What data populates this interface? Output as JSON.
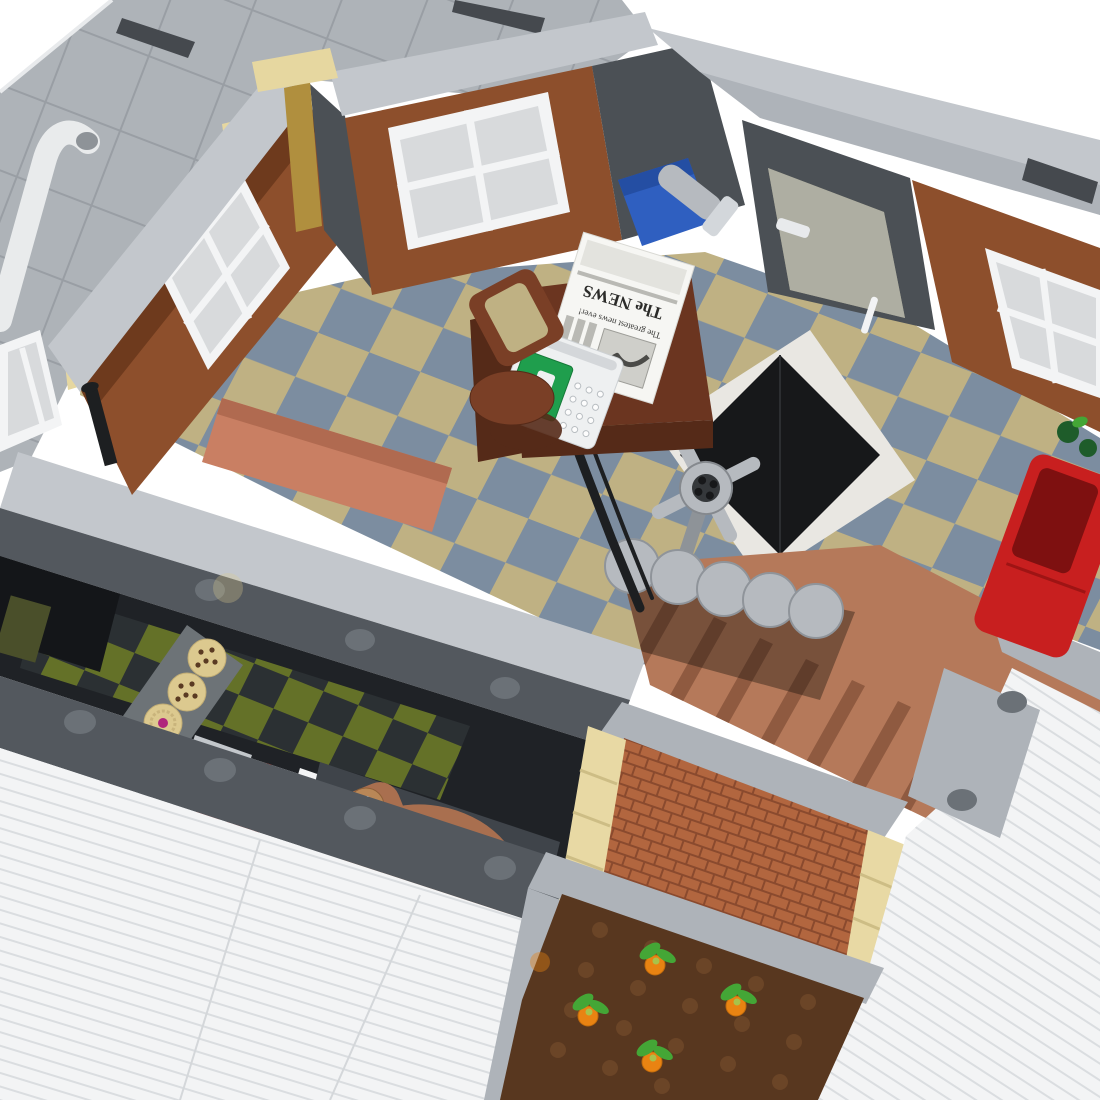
{
  "scene": {
    "subject": "LEGO modular building interior, isometric cutaway render",
    "view": "top-down three-quarter view, white studio background",
    "background": "#ffffff"
  },
  "palette": {
    "bg": "#ffffff",
    "roofGray": "#aeb3b8",
    "roofLine": "#999ea4",
    "capGray": "#c3c7cc",
    "capGray2": "#aeb3b9",
    "darkSill": "#53585e",
    "darkSill2": "#45494e",
    "studGray": "#6b7177",
    "white": "#f3f4f5",
    "windowInset": "#d8dadc",
    "woodMid": "#8d4f2c",
    "woodDark": "#6e3a1d",
    "darkWall": "#4b5055",
    "gold": "#b08f3e",
    "tanTrim": "#e6d7a0",
    "floorTan": "#bfb183",
    "floorBlue": "#7c8da0",
    "floorWhiteTile": "#e9e7e2",
    "hatchBlack": "#17181a",
    "grayLight": "#b6babf",
    "grayMid": "#8e9398",
    "deskBrown": "#6b3520",
    "deskDark": "#552a18",
    "chairBrown": "#7a3f26",
    "salmon": "#c97f63",
    "salmonDark": "#b06a50",
    "sofaRed": "#c81f1f",
    "sofaRedDark": "#7e1010",
    "plantGreen": "#1e5c2a",
    "crateBlue": "#2f5fc0",
    "typewriterGreen": "#1f9e4d",
    "bakeryDark": "#1f2226",
    "oliveFloor": "#6a7828",
    "charFloor": "#2c3134",
    "caseGray": "#6d7377",
    "cookieTan": "#dcc98f",
    "chipBrown": "#5a3a22",
    "jamMagenta": "#b0257c",
    "registerRed": "#c63a2e",
    "keyYellow": "#e8c93e",
    "displayBlue": "#bcd3e0",
    "croissant": "#a96f4f",
    "croissantDark": "#86543a",
    "binGray": "#3f444a",
    "stairBrown": "#b5795a",
    "stairDark": "#8f5a40",
    "brick": "#b2663f",
    "brickGap": "#8a4a2e",
    "quoinTan": "#e8d9a4",
    "soil": "#58371f",
    "soilStud": "#6b4527",
    "carrotOrange": "#e98312",
    "leafGreen": "#44a636",
    "sidingWhite": "#f3f4f5",
    "sidingLine": "#dadde0",
    "railBlack": "#1d1f21",
    "glass": "rgba(152,162,174,0.55)",
    "glassTan": "#cabd92"
  },
  "objects": {
    "roof_terrace": {
      "label": "gray tiled roof terrace",
      "features": [
        "white drain pipe",
        "dark air-vent slots",
        "tan trim pieces"
      ]
    },
    "office": {
      "label": "office room, upper floor",
      "floor": "tan and blue-gray checkerboard tile floor with white triangle tiles",
      "walls": "reddish-brown wood panel walls with white four-pane windows and dark gray sections",
      "newspaper": {
        "masthead": "The NEWS",
        "headline": "The greatest news ever!"
      },
      "items": [
        "wooden desk",
        "newspaper",
        "white typewriter with green panel",
        "reddish-brown swivel chair",
        "blue crate with gray flashlight",
        "black floor hatch",
        "gray vault wheel",
        "salmon bench",
        "red sofa",
        "green plant",
        "glass door",
        "white wall cabinet",
        "golden corner pillar",
        "black stair railing",
        "black lamp post",
        "white paper roll"
      ]
    },
    "staircase": {
      "label": "staircase to ground floor",
      "top_steps": "light gray curved steps",
      "lower_steps": "nougat brown straight steps"
    },
    "bakery": {
      "label": "bakery shop, ground floor",
      "floor": "olive-green and charcoal checkerboard",
      "items": [
        "glass display case",
        "two chocolate-chip cookies",
        "two swirl cookies with magenta jam",
        "red cash register with keypad",
        "light gray stand",
        "white counter",
        "giant croissant sculpture",
        "black gripper tool"
      ]
    },
    "exterior": {
      "label": "exterior details",
      "items": [
        "nougat brick wall",
        "tan corner quoins",
        "carrot garden plate with studs",
        "orange carrots with green tops",
        "white clapboard siding",
        "gray curbs with studs"
      ]
    }
  }
}
